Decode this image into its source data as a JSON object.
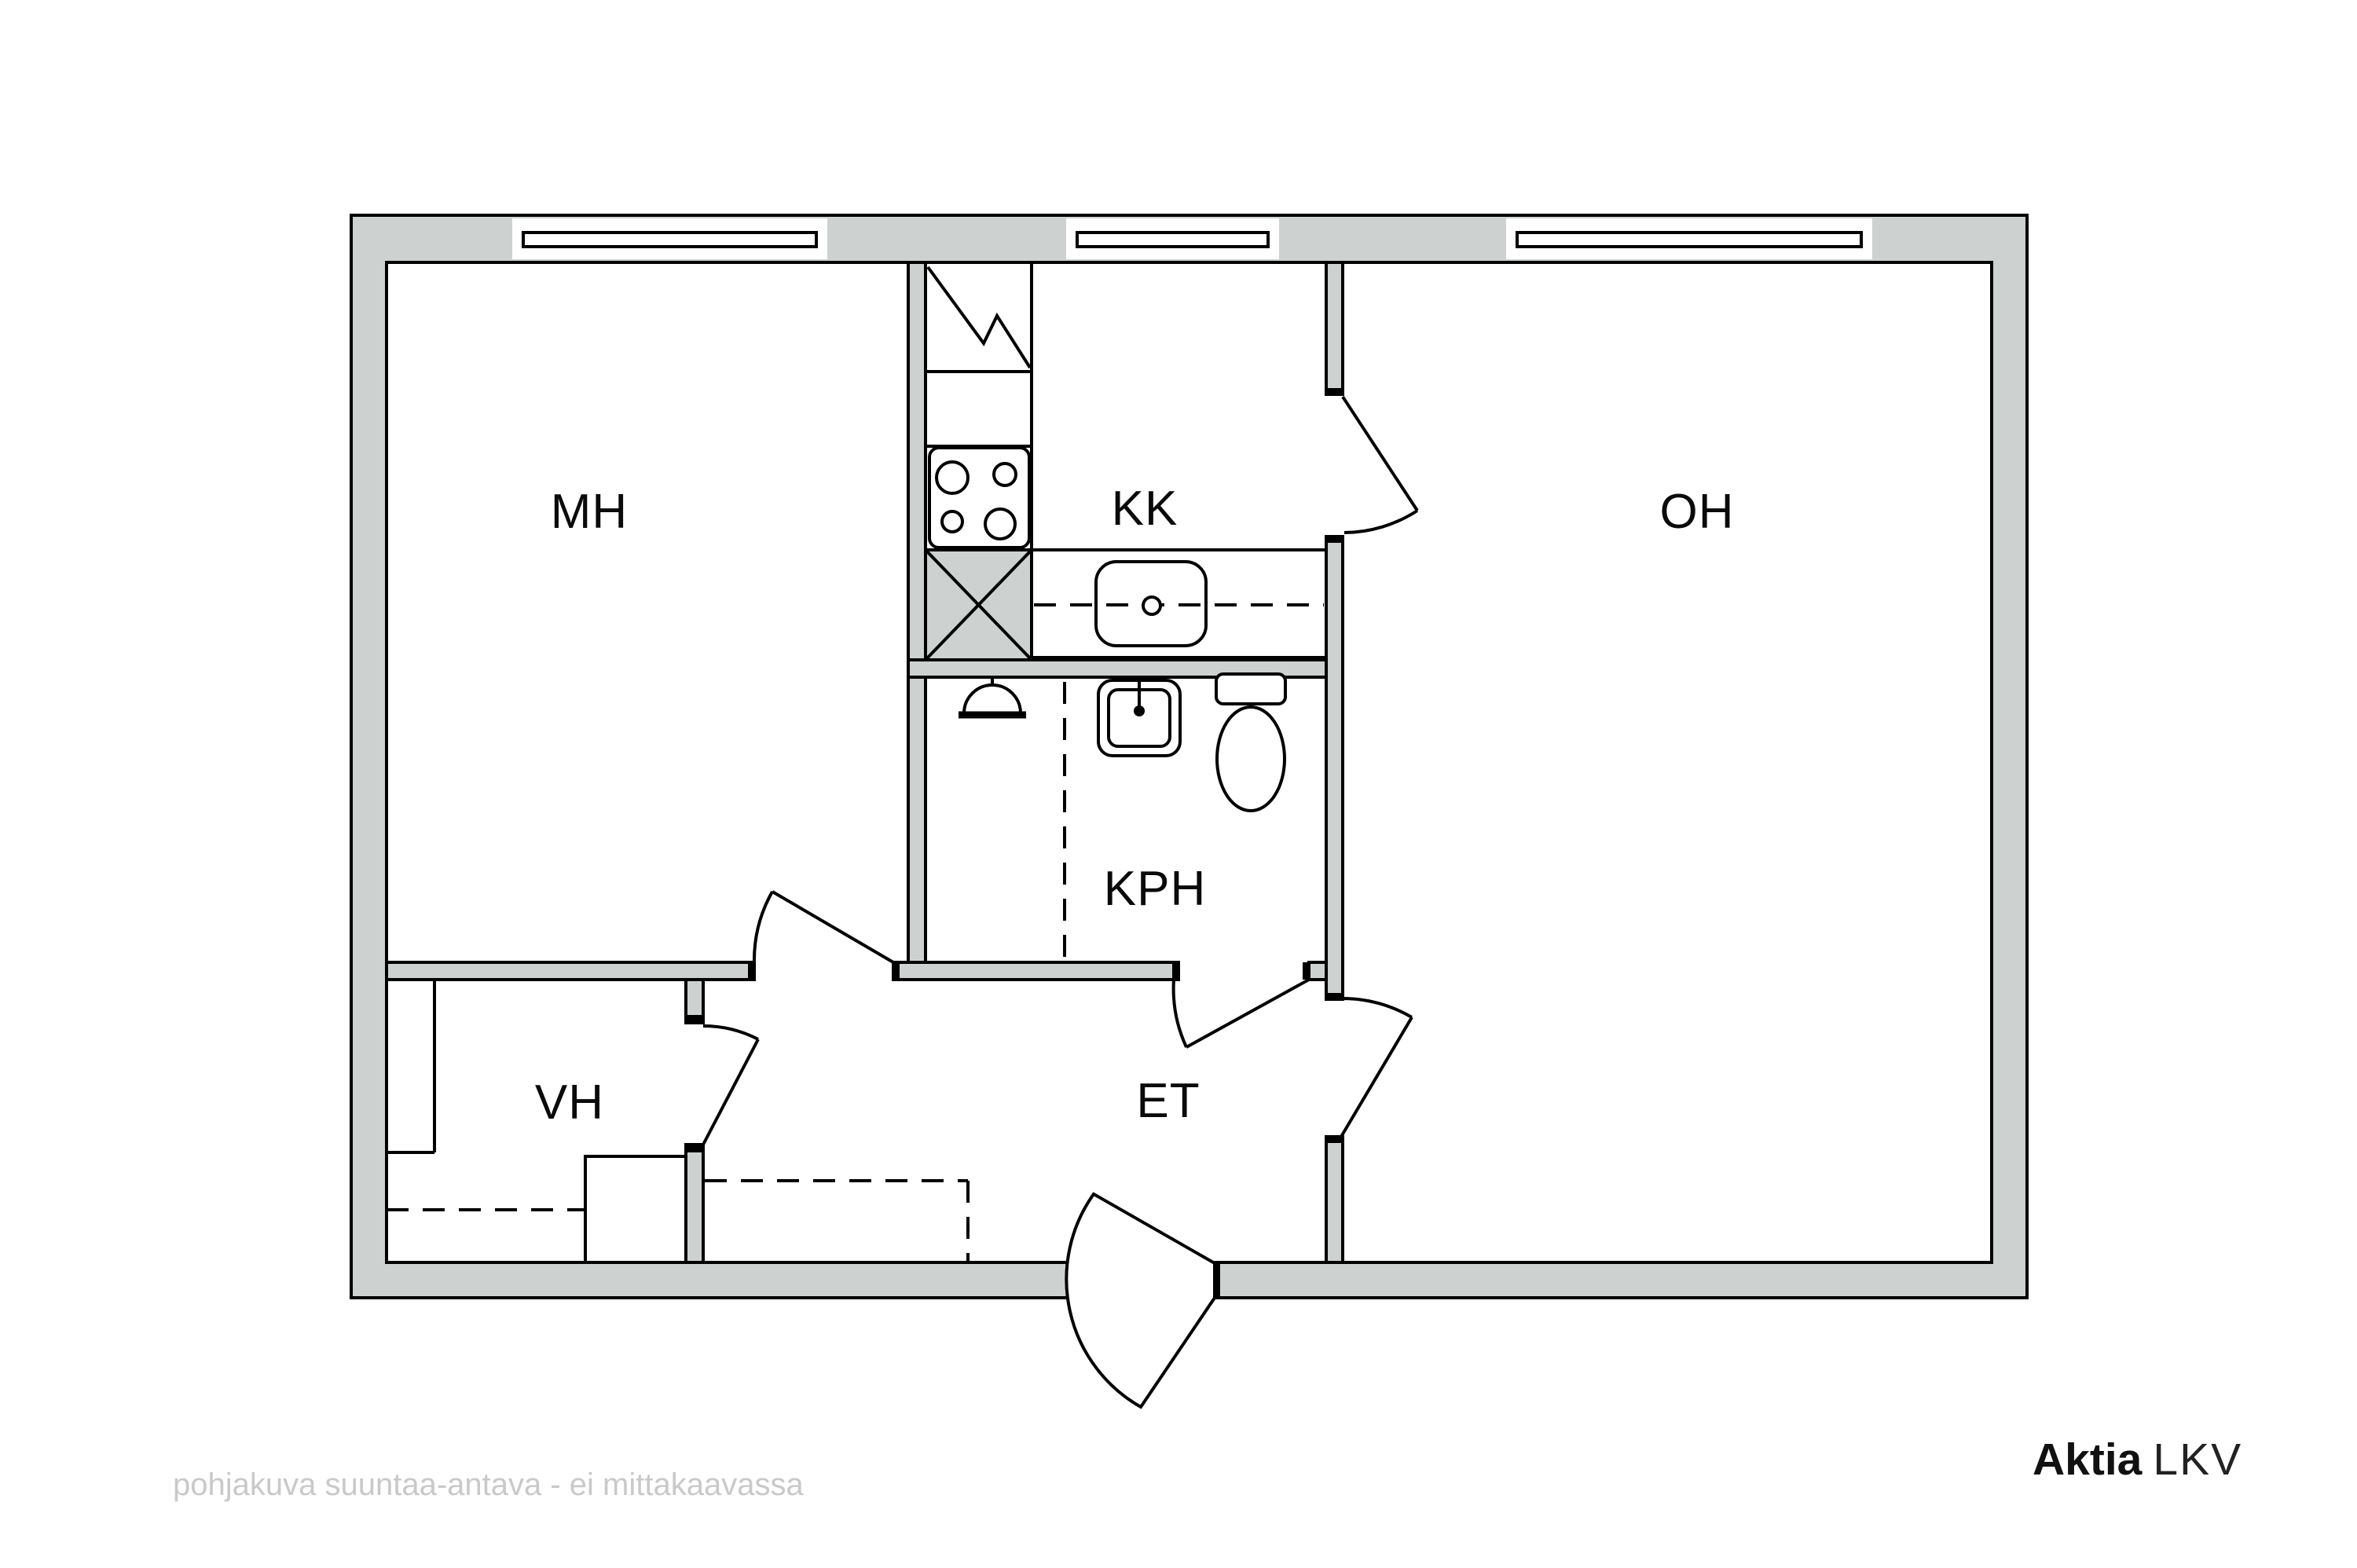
{
  "plan": {
    "rooms": [
      {
        "id": "mh",
        "label": "MH"
      },
      {
        "id": "kk",
        "label": "KK"
      },
      {
        "id": "oh",
        "label": "OH"
      },
      {
        "id": "kph",
        "label": "KPH"
      },
      {
        "id": "vh",
        "label": "VH"
      },
      {
        "id": "et",
        "label": "ET"
      }
    ],
    "fixtures": [
      "fridge",
      "stove",
      "kitchen-sink",
      "shower",
      "washbasin",
      "toilet",
      "wardrobe",
      "entry-wardrobe"
    ],
    "windows_count": 3,
    "doors_count": 6,
    "colors": {
      "wall_fill": "#cdd2d0",
      "line": "#000000",
      "disclaimer_text": "#c9c9c9",
      "background": "#ffffff"
    }
  },
  "footer": {
    "disclaimer": "pohjakuva suuntaa-antava - ei mittakaavassa",
    "brand_bold": "Aktia",
    "brand_light": "LKV"
  }
}
